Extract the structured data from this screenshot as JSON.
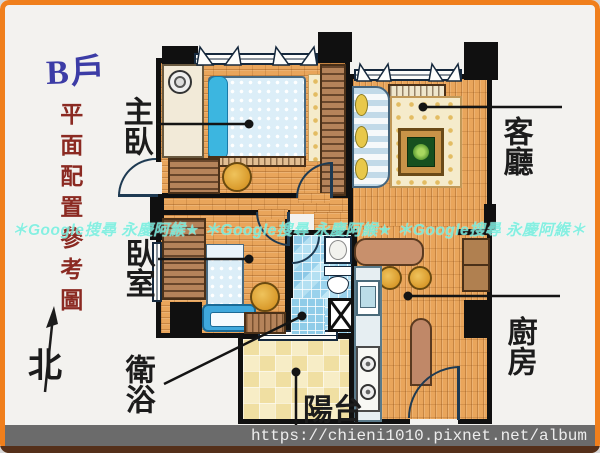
{
  "page": {
    "unit_label": "B戶",
    "subtitle": "平面配置參考圖",
    "watermark": "＊Google搜尋 永慶阿緱★ ＊Google搜尋 永慶阿緱★ ＊Google搜尋 永慶阿緱＊",
    "footer_url": "https://chieni1010.pixnet.net/album"
  },
  "rooms": {
    "master_bedroom": "主臥",
    "living_room": "客廳",
    "bedroom": "臥室",
    "bathroom": "衛浴",
    "kitchen": "廚房",
    "balcony": "陽台"
  },
  "compass": {
    "north": "北"
  },
  "colors": {
    "frame_orange": "#F07F1C",
    "wall_black": "#101010",
    "wood_floor": "#E9A55B",
    "bath_tile_blue": "#A6D6EC",
    "balcony_tile_yellow": "#F0DFA2",
    "accent_bed_blue": "#3CB6E0",
    "title_blue": "#3C3CA6",
    "subtitle_red": "#8B2A22",
    "watermark_cyan": "#78EFE0",
    "footer_bar_gray": "#6B6B6B"
  }
}
